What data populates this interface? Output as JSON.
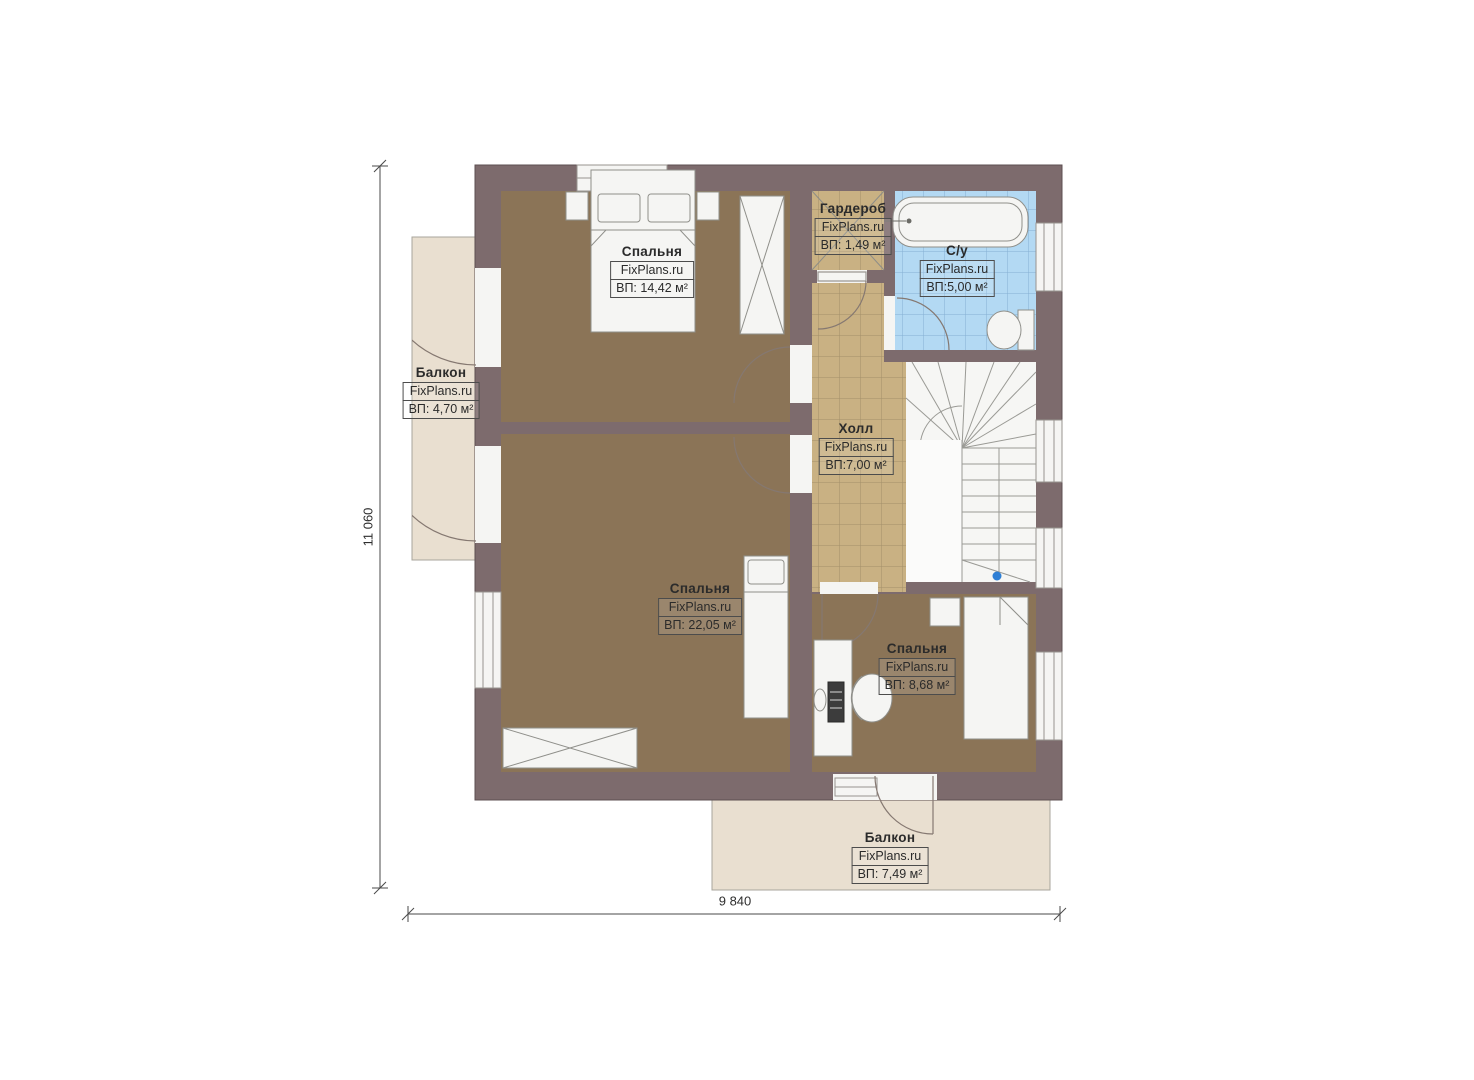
{
  "watermark": "FixPlans.ru",
  "dimensions": {
    "height": "11 060",
    "width": "9 840"
  },
  "rooms": [
    {
      "name": "Спальня",
      "area": "ВП: 14,42 м²"
    },
    {
      "name": "Гардероб",
      "area": "ВП: 1,49 м²"
    },
    {
      "name": "С/у",
      "area": "ВП:5,00 м²"
    },
    {
      "name": "Холл",
      "area": "ВП:7,00 м²"
    },
    {
      "name": "Спальня",
      "area": "ВП: 22,05 м²"
    },
    {
      "name": "Спальня",
      "area": "ВП: 8,68 м²"
    },
    {
      "name": "Балкон",
      "area": "ВП: 4,70 м²"
    },
    {
      "name": "Балкон",
      "area": "ВП: 7,49 м²"
    }
  ],
  "colors": {
    "wall": "#7d6b6d",
    "carpet": "#8b7457",
    "tile_tan": "#c9b183",
    "tile_blue": "#b3d9f3",
    "balcony_floor": "#e9dfd0",
    "stair_marker_blue": "#2e7fd5"
  }
}
